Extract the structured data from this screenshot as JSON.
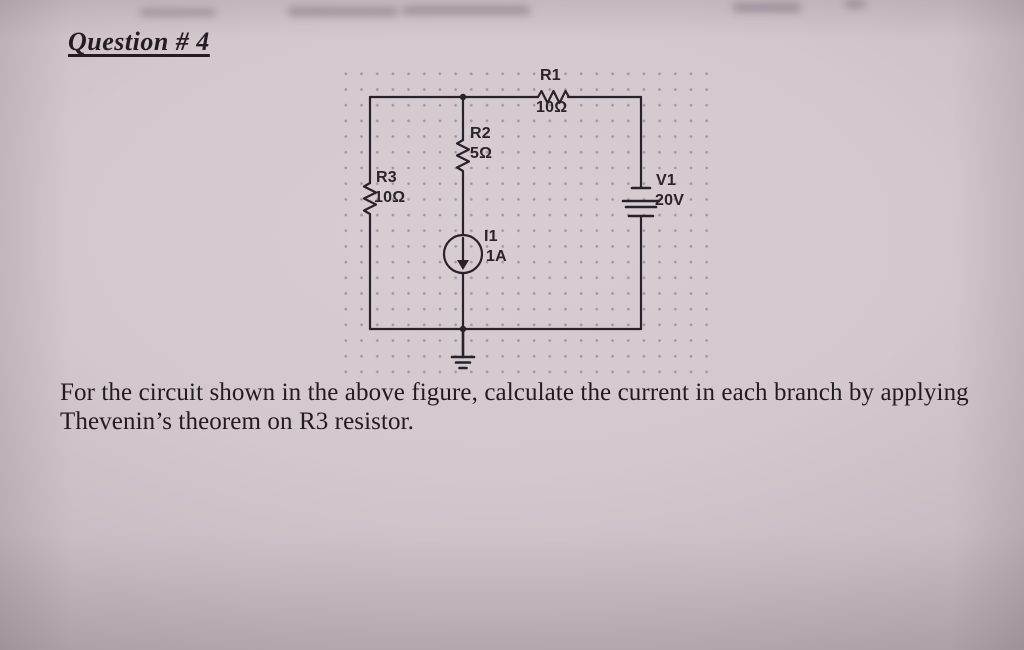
{
  "page": {
    "title": "Question # 4",
    "question_lines": [
      "For the circuit shown in the above figure, calculate the current in each branch by applying",
      "Thevenin’s theorem on R3 resistor."
    ]
  },
  "circuit": {
    "components": [
      {
        "id": "R1",
        "type": "resistor",
        "label": "R1",
        "value": "10Ω"
      },
      {
        "id": "R2",
        "type": "resistor",
        "label": "R2",
        "value": "5Ω"
      },
      {
        "id": "R3",
        "type": "resistor",
        "label": "R3",
        "value": "10Ω"
      },
      {
        "id": "I1",
        "type": "current-source",
        "label": "I1",
        "value": "1A"
      },
      {
        "id": "V1",
        "type": "dc-voltage-source",
        "label": "V1",
        "value": "20V"
      }
    ],
    "ground": "earth ground at bottom-center node"
  },
  "colors": {
    "paper_center": "#d7cdd3",
    "paper_edge": "#a89da4",
    "ink": "#29222a",
    "grid_dot": "#5c505c"
  }
}
